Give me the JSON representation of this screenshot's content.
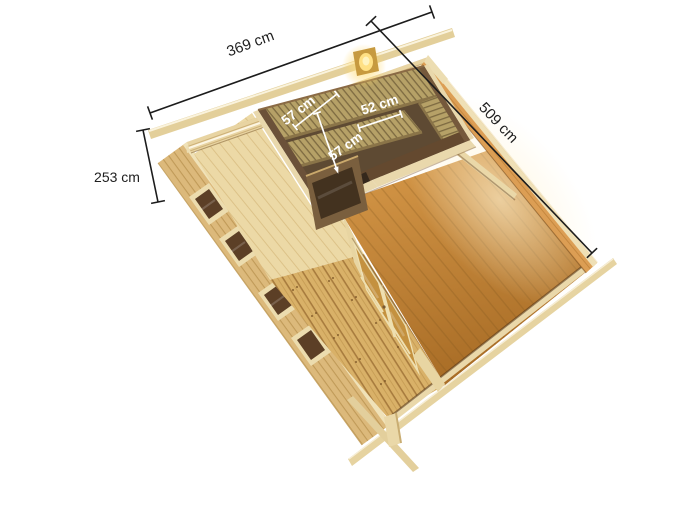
{
  "view": {
    "title": "Wooden sauna cabin — top view dimension diagram",
    "background_color": "#ffffff"
  },
  "dimension_labels": {
    "front_width": "369 cm",
    "side_length": "509 cm",
    "wall_height": "253 cm",
    "bench_upper_depth": "57 cm",
    "bench_side_depth": "52 cm",
    "bench_lower_depth": "57 cm"
  },
  "colors": {
    "dimension_line": "#1c1c1c",
    "interior_dimension_text": "#ffffff",
    "beam_wood": "#e6d2a0",
    "wall_exterior": "#dcb97b",
    "wall_back_interior": "#e8d4a2",
    "wall_right_interior": "#dc9e54",
    "floor_main_room": "#c8893a",
    "floor_anteroom": "#ecd9a6",
    "terrace_deck": "#d9b168",
    "sauna_wall_dark": "#6b5139",
    "sauna_bench": "#b6a167",
    "sauna_floor": "#5e4a33",
    "door_glass": "#c4913f",
    "window_pane": "#5c3f26",
    "lamp_glow": "#ffd97a"
  }
}
